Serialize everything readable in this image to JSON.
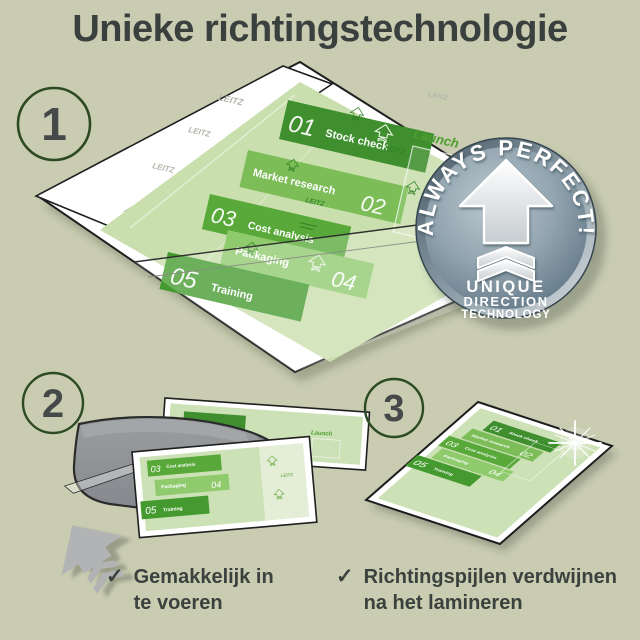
{
  "title": "Unieke richtingstechnologie",
  "step_markers": [
    "1",
    "2",
    "3"
  ],
  "badge": {
    "ribbon": "ALWAYS PERFECT!",
    "line1": "UNIQUE",
    "line2": "DIRECTION",
    "line3": "TECHNOLOGY"
  },
  "doc": {
    "watermark": "LEITZ",
    "launch": "Launch",
    "items": [
      {
        "num": "01",
        "label": "Stock check"
      },
      {
        "num": "02",
        "label": "Market research"
      },
      {
        "num": "03",
        "label": "Cost analysis"
      },
      {
        "num": "04",
        "label": "Packaging"
      },
      {
        "num": "05",
        "label": "Training"
      }
    ]
  },
  "captions": [
    {
      "check": "✓",
      "line1": "Gemakkelijk in",
      "line2": "te voeren"
    },
    {
      "check": "✓",
      "line1": "Richtingspijlen verdwijnen",
      "line2": "na het lamineren"
    }
  ],
  "colors": {
    "background": "#c9ccb1",
    "title_text": "#3a403d",
    "green_dark": "#3f8f2e",
    "green_mid": "#58a93a",
    "green_light": "#8fca6d",
    "page_green": "#cadfae",
    "badge_steel": "#647988",
    "machine_gray": "#8f9293",
    "arrow_gray": "#b1b3b4",
    "circle_border": "#2c4a24"
  }
}
